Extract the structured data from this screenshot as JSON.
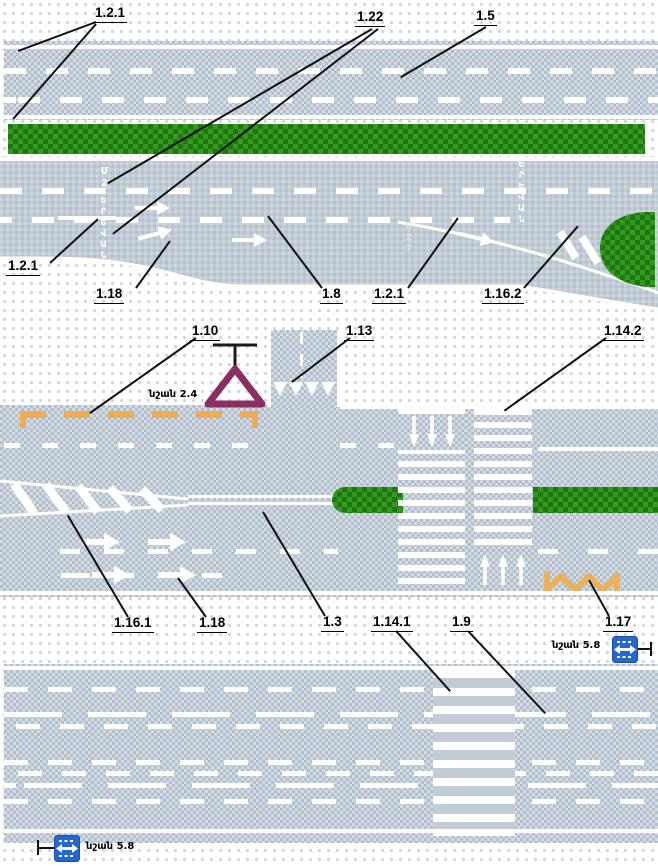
{
  "figure": {
    "kind": "road-markings-diagram"
  },
  "colors": {
    "road": "#c2ccd6",
    "green": "#2f9420",
    "green_dark": "#1e7812",
    "marking_white": "#ffffff",
    "no_stop_yellow": "#eead55",
    "give_way_purple": "#8a2f62",
    "sign_blue": "#2667cf",
    "ink": "#000000"
  },
  "callouts": {
    "k121a": "1.2.1",
    "k122": "1.22",
    "k15": "1.5",
    "k121b": "1.2.1",
    "k118a": "1.18",
    "k18": "1.8",
    "k121c": "1.2.1",
    "k1162": "1.16.2",
    "k110": "1.10",
    "k113": "1.13",
    "k1142": "1.14.2",
    "k1161": "1.16.1",
    "k118b": "1.18",
    "k13": "1.3",
    "k1141": "1.14.1",
    "k19": "1.9",
    "k117": "1.17"
  },
  "sign_labels": {
    "give_way": "նշան 2.4",
    "rev_right": "նշան 5.8",
    "rev_bottom": "նշան 5.8"
  },
  "road_texts": {
    "route_upper": "Մ2",
    "city_left": "ԵՐԵՎԱՆ",
    "city_right": "ԵՐԵՎԱՆ",
    "route_right": "Մ27"
  }
}
